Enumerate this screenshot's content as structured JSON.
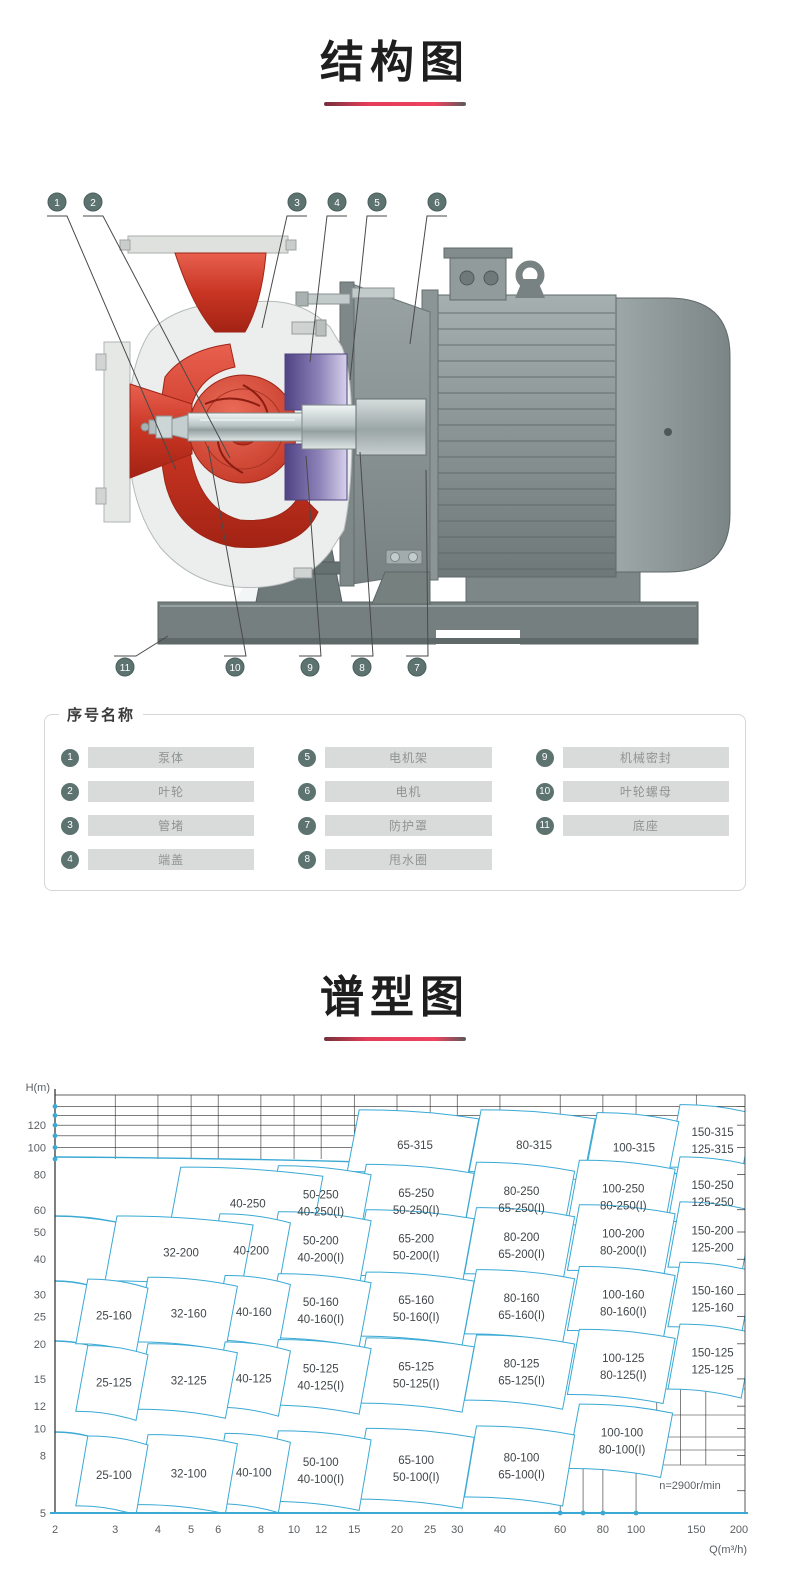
{
  "page": {
    "title_structure": "结构图",
    "title_spectrum": "谱型图"
  },
  "structure_diagram": {
    "callouts_top": [
      "1",
      "2",
      "3",
      "4",
      "5",
      "6"
    ],
    "callouts_bottom": [
      "11",
      "10",
      "9",
      "8",
      "7"
    ]
  },
  "legend": {
    "title": "序号名称",
    "items": [
      {
        "num": "1",
        "name": "泵体"
      },
      {
        "num": "2",
        "name": "叶轮"
      },
      {
        "num": "3",
        "name": "管堵"
      },
      {
        "num": "4",
        "name": "端盖"
      },
      {
        "num": "5",
        "name": "电机架"
      },
      {
        "num": "6",
        "name": "电机"
      },
      {
        "num": "7",
        "name": "防护罩"
      },
      {
        "num": "8",
        "name": "甩水圈"
      },
      {
        "num": "9",
        "name": "机械密封"
      },
      {
        "num": "10",
        "name": "叶轮螺母"
      },
      {
        "num": "11",
        "name": "底座"
      }
    ]
  },
  "chart_data": {
    "type": "area",
    "title": "谱型图",
    "xlabel": "Q(m³/h)",
    "ylabel": "H(m)",
    "x_scale": "log",
    "y_scale": "log",
    "x_range": [
      2,
      200
    ],
    "y_range": [
      5,
      150
    ],
    "x_ticks": [
      2,
      3,
      4,
      5,
      6,
      8,
      10,
      12,
      15,
      20,
      25,
      30,
      40,
      60,
      80,
      100,
      150,
      200
    ],
    "y_ticks": [
      120,
      100,
      80,
      60,
      50,
      40,
      30,
      25,
      20,
      15,
      12,
      10,
      8,
      5
    ],
    "grid_top_h_lines": [
      100,
      110,
      120,
      130,
      140
    ],
    "annotation": "n=2900r/min",
    "accent_color": "#3aa9d4",
    "regions": [
      {
        "models": [
          "65-315"
        ],
        "q": [
          14.3,
          32
        ],
        "h": [
          82,
          136
        ]
      },
      {
        "models": [
          "80-315"
        ],
        "q": [
          32.5,
          70
        ],
        "h": [
          82,
          136
        ]
      },
      {
        "models": [
          "100-315"
        ],
        "q": [
          71,
          123
        ],
        "h": [
          80,
          133
        ]
      },
      {
        "models": [
          "150-315",
          "125-315"
        ],
        "q": [
          124,
          203
        ],
        "h": [
          85,
          142
        ]
      },
      {
        "models": [
          "40-250"
        ],
        "q": [
          4.3,
          11.2
        ],
        "h": [
          50,
          85
        ]
      },
      {
        "models": [
          "50-250",
          "40-250(I)"
        ],
        "q": [
          8.3,
          15.5
        ],
        "h": [
          50.5,
          86
        ]
      },
      {
        "models": [
          "65-250",
          "50-250(I)"
        ],
        "q": [
          15,
          31
        ],
        "h": [
          51,
          87
        ]
      },
      {
        "models": [
          "80-250",
          "65-250(I)"
        ],
        "q": [
          31.5,
          61
        ],
        "h": [
          52,
          88.5
        ]
      },
      {
        "models": [
          "100-250",
          "80-250(I)"
        ],
        "q": [
          63,
          120
        ],
        "h": [
          53,
          90
        ]
      },
      {
        "models": [
          "150-250",
          "125-250"
        ],
        "q": [
          124,
          203
        ],
        "h": [
          54.5,
          92.5
        ]
      },
      {
        "models": [
          "32-200"
        ],
        "q": [
          2.8,
          7.0
        ],
        "h": [
          33.5,
          57
        ]
      },
      {
        "models": [
          "40-200"
        ],
        "q": [
          5.6,
          9.0
        ],
        "h": [
          34,
          58
        ]
      },
      {
        "models": [
          "50-200",
          "40-200(I)"
        ],
        "q": [
          8.3,
          15.5
        ],
        "h": [
          34.5,
          59
        ]
      },
      {
        "models": [
          "65-200",
          "50-200(I)"
        ],
        "q": [
          15,
          31
        ],
        "h": [
          35,
          60
        ]
      },
      {
        "models": [
          "80-200",
          "65-200(I)"
        ],
        "q": [
          31.5,
          61
        ],
        "h": [
          35.5,
          61
        ]
      },
      {
        "models": [
          "100-200",
          "80-200(I)"
        ],
        "q": [
          63,
          120
        ],
        "h": [
          36.5,
          62.5
        ]
      },
      {
        "models": [
          "150-200",
          "125-200"
        ],
        "q": [
          124,
          203
        ],
        "h": [
          37.5,
          64
        ]
      },
      {
        "models": [
          "25-160"
        ],
        "q": [
          2.3,
          3.45
        ],
        "h": [
          20,
          34
        ]
      },
      {
        "models": [
          "32-160"
        ],
        "q": [
          3.45,
          6.3
        ],
        "h": [
          20.3,
          34.5
        ]
      },
      {
        "models": [
          "40-160"
        ],
        "q": [
          5.8,
          9.0
        ],
        "h": [
          20.6,
          35
        ]
      },
      {
        "models": [
          "50-160",
          "40-160(I)"
        ],
        "q": [
          8.3,
          15.5
        ],
        "h": [
          21,
          35.5
        ]
      },
      {
        "models": [
          "65-160",
          "50-160(I)"
        ],
        "q": [
          15,
          31
        ],
        "h": [
          21.3,
          36
        ]
      },
      {
        "models": [
          "80-160",
          "65-160(I)"
        ],
        "q": [
          31.5,
          61
        ],
        "h": [
          21.7,
          36.7
        ]
      },
      {
        "models": [
          "100-160",
          "80-160(I)"
        ],
        "q": [
          63,
          120
        ],
        "h": [
          22.3,
          37.7
        ]
      },
      {
        "models": [
          "150-160",
          "125-160"
        ],
        "q": [
          124,
          203
        ],
        "h": [
          23,
          39
        ]
      },
      {
        "models": [
          "25-125"
        ],
        "q": [
          2.3,
          3.45
        ],
        "h": [
          11.5,
          19.7
        ]
      },
      {
        "models": [
          "32-125"
        ],
        "q": [
          3.45,
          6.3
        ],
        "h": [
          11.7,
          20
        ]
      },
      {
        "models": [
          "40-125"
        ],
        "q": [
          5.8,
          9.0
        ],
        "h": [
          11.9,
          20.3
        ]
      },
      {
        "models": [
          "50-125",
          "40-125(I)"
        ],
        "q": [
          8.3,
          15.5
        ],
        "h": [
          12.1,
          20.7
        ]
      },
      {
        "models": [
          "65-125",
          "50-125(I)"
        ],
        "q": [
          15,
          31
        ],
        "h": [
          12.3,
          21
        ]
      },
      {
        "models": [
          "80-125",
          "65-125(I)"
        ],
        "q": [
          31.5,
          61
        ],
        "h": [
          12.6,
          21.5
        ]
      },
      {
        "models": [
          "100-125",
          "80-125(I)"
        ],
        "q": [
          63,
          120
        ],
        "h": [
          13.2,
          22.5
        ]
      },
      {
        "models": [
          "150-125",
          "125-125"
        ],
        "q": [
          124,
          203
        ],
        "h": [
          13.8,
          23.5
        ]
      },
      {
        "models": [
          "25-100"
        ],
        "q": [
          2.3,
          3.45
        ],
        "h": [
          5.3,
          9.4
        ]
      },
      {
        "models": [
          "32-100"
        ],
        "q": [
          3.45,
          6.3
        ],
        "h": [
          5.35,
          9.5
        ]
      },
      {
        "models": [
          "40-100"
        ],
        "q": [
          5.8,
          9.0
        ],
        "h": [
          5.4,
          9.6
        ]
      },
      {
        "models": [
          "50-100",
          "40-100(I)"
        ],
        "q": [
          8.3,
          15.5
        ],
        "h": [
          5.5,
          9.8
        ]
      },
      {
        "models": [
          "65-100",
          "50-100(I)"
        ],
        "q": [
          15,
          31
        ],
        "h": [
          5.6,
          10
        ]
      },
      {
        "models": [
          "80-100",
          "65-100(I)"
        ],
        "q": [
          31.5,
          61
        ],
        "h": [
          5.7,
          10.2
        ]
      },
      {
        "models": [
          "100-100",
          "80-100(I)"
        ],
        "q": [
          63,
          118
        ],
        "h": [
          7.2,
          12.2
        ]
      }
    ]
  }
}
